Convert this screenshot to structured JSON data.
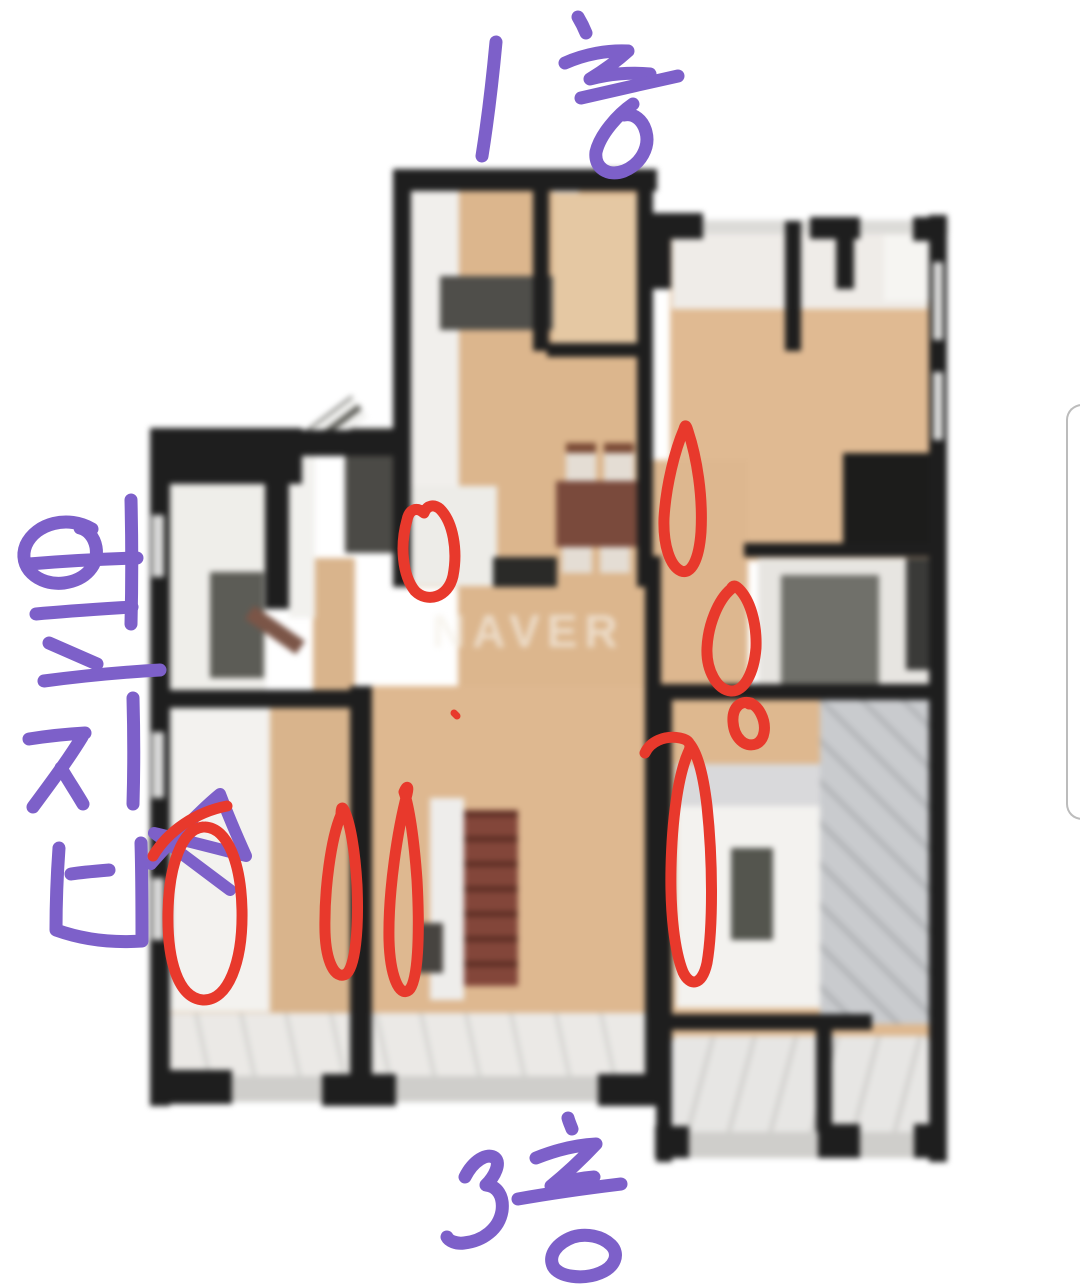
{
  "watermark": {
    "text": "NAVER"
  },
  "handwritten_labels": {
    "top": {
      "text": "1층",
      "color": "#7d60c9"
    },
    "left": {
      "text": "옆집",
      "color": "#7d60c9"
    },
    "bottom": {
      "text": "3층",
      "color": "#7d60c9"
    }
  },
  "markers": {
    "red_color": "#e8392c",
    "red_circle_count": 8,
    "red_dot_count": 1,
    "purple_triangle_count": 1
  },
  "scroll_indicator": {
    "visible": "true"
  }
}
